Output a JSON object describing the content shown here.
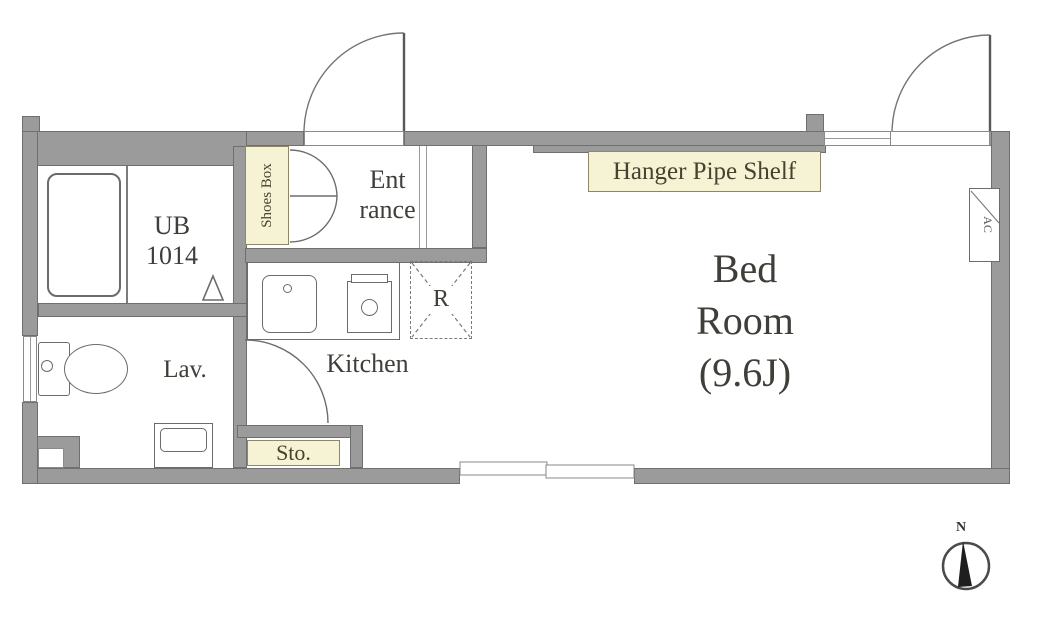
{
  "labels": {
    "ub": {
      "line1": "UB",
      "line2": "1014"
    },
    "lav": "Lav.",
    "kitchen": "Kitchen",
    "entrance": {
      "line1": "Ent",
      "line2": "rance"
    },
    "shoes_box": "Shoes Box",
    "storage": "Sto.",
    "hanger_shelf": "Hanger Pipe Shelf",
    "bedroom": {
      "line1": "Bed",
      "line2": "Room",
      "line3": "(9.6J)"
    },
    "refrigerator": "R",
    "air_conditioner": "AC",
    "compass_north": "N"
  },
  "colors": {
    "wall": "#9b9b9b",
    "wall_edge": "#6f6f6f",
    "tag_background": "#f6f3d4",
    "tag_border": "#8e8868",
    "line": "#707070",
    "text": "#403e39"
  }
}
